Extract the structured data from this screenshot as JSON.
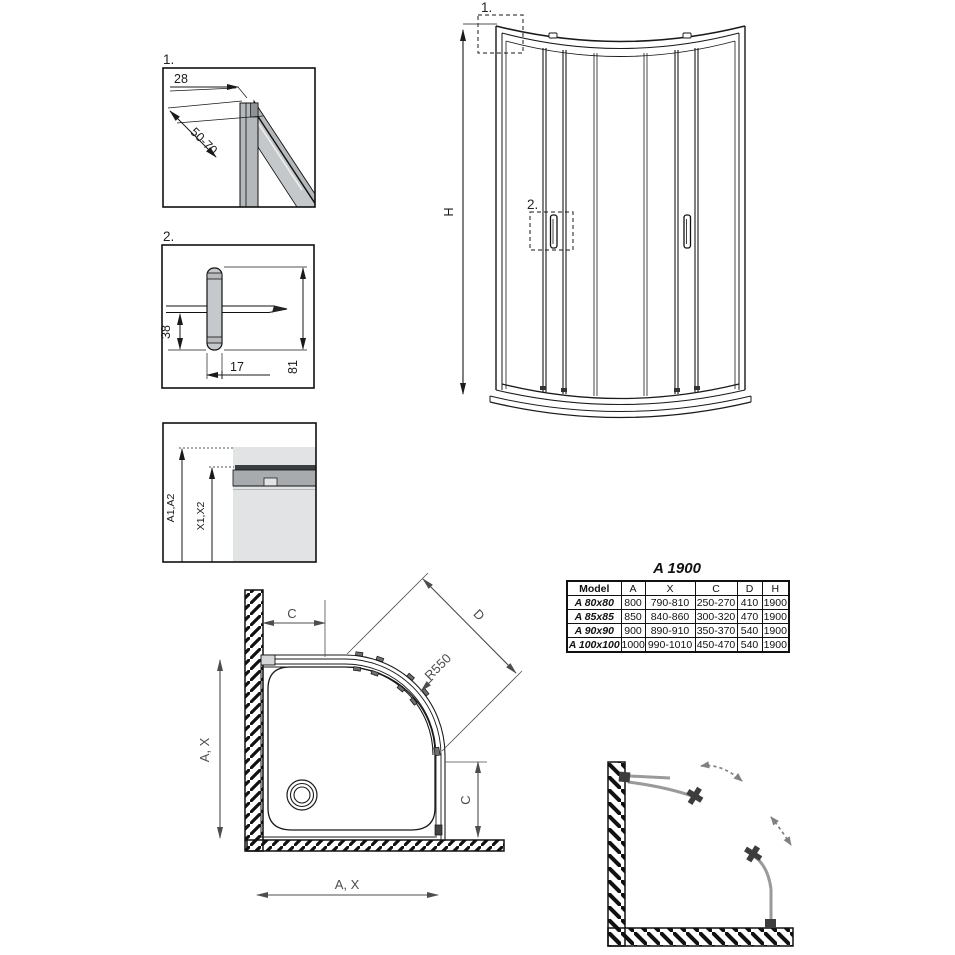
{
  "detail1": {
    "label": "1.",
    "dims": {
      "width": "28",
      "range": "50-70"
    }
  },
  "detail2": {
    "label": "2.",
    "dims": {
      "depth": "38",
      "width": "17",
      "height": "81"
    }
  },
  "detail3": {
    "dims": {
      "outer": "A1,A2",
      "inner": "X1,X2"
    }
  },
  "elevation": {
    "callout1": "1.",
    "callout2": "2.",
    "height_label": "H"
  },
  "plan": {
    "labels": {
      "width_top": "C",
      "diagonal": "D",
      "radius": "R550",
      "side": "A, X",
      "door": "C",
      "bottom": "A, X"
    }
  },
  "table": {
    "title": "A 1900",
    "headers": [
      "Model",
      "A",
      "X",
      "C",
      "D",
      "H"
    ],
    "rows": [
      [
        "A 80x80",
        "800",
        "790-810",
        "250-270",
        "410",
        "1900"
      ],
      [
        "A 85x85",
        "850",
        "840-860",
        "300-320",
        "470",
        "1900"
      ],
      [
        "A 90x90",
        "900",
        "890-910",
        "350-370",
        "540",
        "1900"
      ],
      [
        "A 100x100",
        "1000",
        "990-1010",
        "450-470",
        "540",
        "1900"
      ]
    ]
  },
  "colors": {
    "line": "#1a1a1a",
    "profile_gray": "#b4b8ba",
    "glass_gray": "#c5c8ca",
    "light_gray": "#e1e3e4",
    "dim_gray": "#4d4d4d",
    "door_gray": "#9a9a9a",
    "dark_part": "#3d3d3d"
  }
}
